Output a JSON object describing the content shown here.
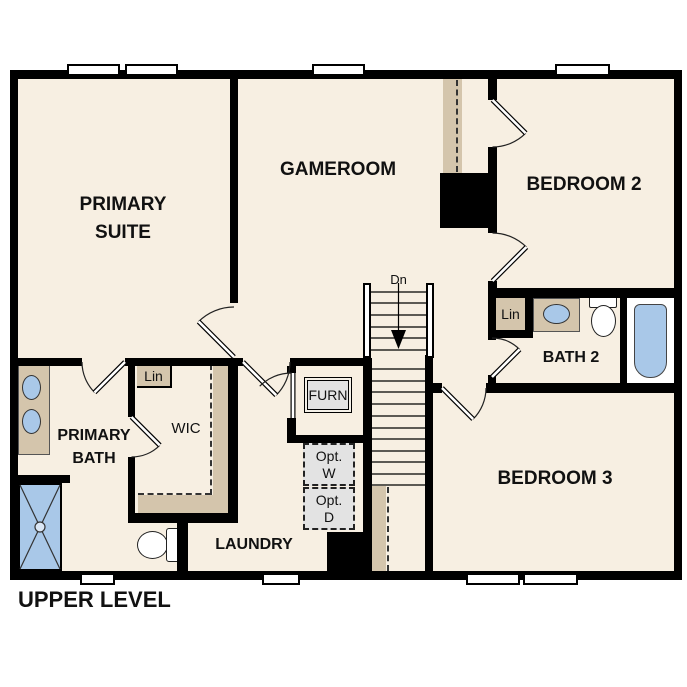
{
  "title": "UPPER LEVEL",
  "rooms": {
    "primary_suite": {
      "line1": "PRIMARY",
      "line2": "SUITE"
    },
    "gameroom": {
      "label": "GAMEROOM"
    },
    "bedroom2": {
      "label": "BEDROOM 2"
    },
    "bath2": {
      "label": "BATH 2"
    },
    "bedroom3": {
      "label": "BEDROOM 3"
    },
    "primary_bath": {
      "line1": "PRIMARY",
      "line2": "BATH"
    },
    "wic": {
      "label": "WIC"
    },
    "laundry": {
      "label": "LAUNDRY"
    }
  },
  "closets": {
    "linen_wic": "Lin",
    "linen_bath2": "Lin"
  },
  "equipment": {
    "furnace": "FURN",
    "opt_washer": {
      "line1": "Opt.",
      "line2": "W"
    },
    "opt_dryer": {
      "line1": "Opt.",
      "line2": "D"
    }
  },
  "stairs": {
    "down_label": "Dn"
  },
  "colors": {
    "floor": "#f7efe2",
    "wall": "#000000",
    "casework_tan": "#d4c5ac",
    "fixture_blue": "#a9c8e8",
    "equipment_gray": "#e3e3e3",
    "text": "#111111"
  }
}
